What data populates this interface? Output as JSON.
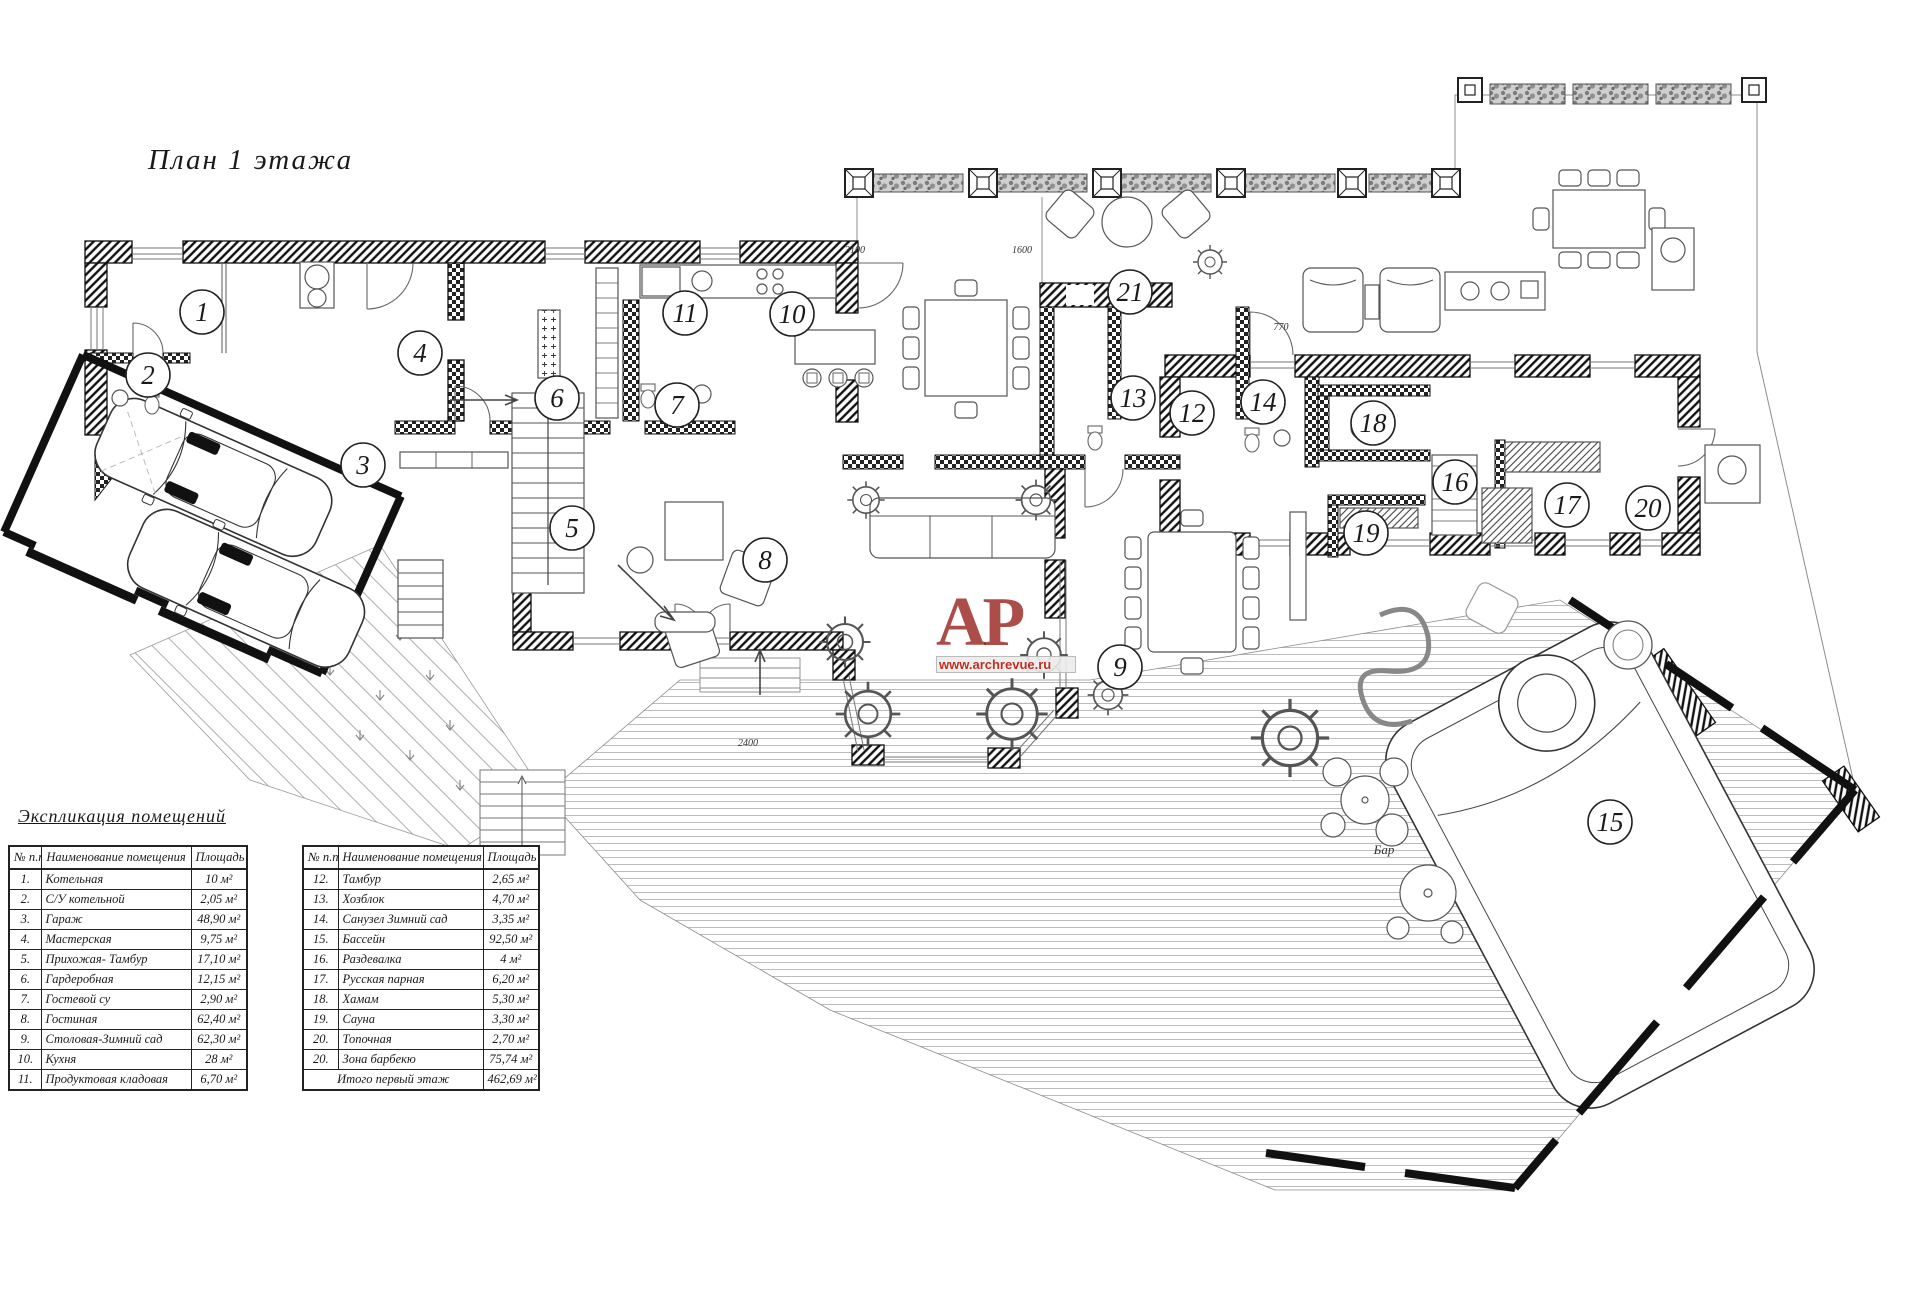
{
  "title": "План  1 этажа",
  "explication": {
    "heading": "Экспликация помещений",
    "col_headers": {
      "num": "№ п.п.",
      "name": "Наименование помещения",
      "area": "Площадь"
    },
    "table1": [
      {
        "num": "1.",
        "name": "Котельная",
        "area": "10 м²"
      },
      {
        "num": "2.",
        "name": "С/У котельной",
        "area": "2,05 м²"
      },
      {
        "num": "3.",
        "name": "Гараж",
        "area": "48,90 м²"
      },
      {
        "num": "4.",
        "name": "Мастерская",
        "area": "9,75 м²"
      },
      {
        "num": "5.",
        "name": "Прихожая- Тамбур",
        "area": "17,10 м²"
      },
      {
        "num": "6.",
        "name": "Гардеробная",
        "area": "12,15 м²"
      },
      {
        "num": "7.",
        "name": "Гостевой су",
        "area": "2,90 м²"
      },
      {
        "num": "8.",
        "name": "Гостиная",
        "area": "62,40 м²"
      },
      {
        "num": "9.",
        "name": "Столовая-Зимний сад",
        "area": "62,30 м²"
      },
      {
        "num": "10.",
        "name": "Кухня",
        "area": "28 м²"
      },
      {
        "num": "11.",
        "name": "Продуктовая кладовая",
        "area": "6,70 м²"
      }
    ],
    "table2": [
      {
        "num": "12.",
        "name": "Тамбур",
        "area": "2,65 м²"
      },
      {
        "num": "13.",
        "name": "Хозблок",
        "area": "4,70 м²"
      },
      {
        "num": "14.",
        "name": "Санузел Зимний сад",
        "area": "3,35 м²"
      },
      {
        "num": "15.",
        "name": "Бассейн",
        "area": "92,50 м²"
      },
      {
        "num": "16.",
        "name": "Раздевалка",
        "area": "4 м²"
      },
      {
        "num": "17.",
        "name": "Русская парная",
        "area": "6,20 м²"
      },
      {
        "num": "18.",
        "name": "Хамам",
        "area": "5,30 м²"
      },
      {
        "num": "19.",
        "name": "Сауна",
        "area": "3,30 м²"
      },
      {
        "num": "20.",
        "name": "Топочная",
        "area": "2,70 м²"
      },
      {
        "num": "20.",
        "name": "Зона барбекю",
        "area": "75,74 м²"
      }
    ],
    "total": {
      "label": "Итого первый этаж",
      "area": "462,69 м²"
    }
  },
  "plan": {
    "room_markers": [
      {
        "n": "1",
        "x": 202,
        "y": 312
      },
      {
        "n": "2",
        "x": 148,
        "y": 375
      },
      {
        "n": "3",
        "x": 363,
        "y": 465
      },
      {
        "n": "4",
        "x": 420,
        "y": 353
      },
      {
        "n": "5",
        "x": 572,
        "y": 528
      },
      {
        "n": "6",
        "x": 557,
        "y": 398
      },
      {
        "n": "7",
        "x": 677,
        "y": 405
      },
      {
        "n": "8",
        "x": 765,
        "y": 560
      },
      {
        "n": "9",
        "x": 1120,
        "y": 667
      },
      {
        "n": "10",
        "x": 792,
        "y": 314
      },
      {
        "n": "11",
        "x": 685,
        "y": 313
      },
      {
        "n": "12",
        "x": 1192,
        "y": 413
      },
      {
        "n": "13",
        "x": 1133,
        "y": 398
      },
      {
        "n": "14",
        "x": 1263,
        "y": 402
      },
      {
        "n": "15",
        "x": 1610,
        "y": 822
      },
      {
        "n": "16",
        "x": 1455,
        "y": 482
      },
      {
        "n": "17",
        "x": 1567,
        "y": 505
      },
      {
        "n": "18",
        "x": 1373,
        "y": 423
      },
      {
        "n": "19",
        "x": 1366,
        "y": 533
      },
      {
        "n": "20",
        "x": 1648,
        "y": 508
      },
      {
        "n": "21",
        "x": 1130,
        "y": 292
      }
    ],
    "dim_labels": [
      {
        "text": "3100",
        "x": 855,
        "y": 253
      },
      {
        "text": "1600",
        "x": 1022,
        "y": 253
      },
      {
        "text": "770",
        "x": 1281,
        "y": 330
      },
      {
        "text": "2400",
        "x": 748,
        "y": 746
      }
    ],
    "bar_label": {
      "text": "Бар",
      "x": 1384,
      "y": 854
    }
  },
  "watermark": {
    "initials": "АР",
    "url": "www.archrevue.ru",
    "color": "#941c16"
  },
  "colors": {
    "ink": "#1a1a1a",
    "thin": "#666666",
    "deck": "#aaaaaa",
    "red": "#c22a1d"
  }
}
